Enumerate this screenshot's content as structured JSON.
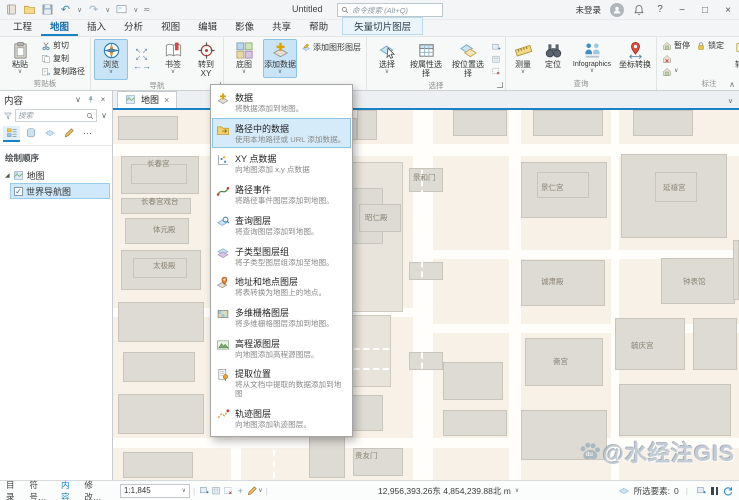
{
  "colors": {
    "accent": "#1a82c4",
    "tab_highlight": "#c9e4f6",
    "selection": "#cfe9fb",
    "map_bg": "#f8f1e8"
  },
  "titlebar": {
    "title": "Untitled",
    "search_placeholder": "命令搜索 (Alt+Q)",
    "signin": "未登录",
    "minimize": "−",
    "maximize": "□",
    "close": "×"
  },
  "ribbon_tabs": [
    {
      "label": "工程"
    },
    {
      "label": "地图",
      "active": true
    },
    {
      "label": "插入"
    },
    {
      "label": "分析"
    },
    {
      "label": "视图"
    },
    {
      "label": "编辑"
    },
    {
      "label": "影像"
    },
    {
      "label": "共享"
    },
    {
      "label": "帮助"
    }
  ],
  "contextual_tab": "矢量切片图层",
  "ribbon": {
    "paste": "粘贴",
    "cut": "剪切",
    "copy": "复制",
    "copy_path": "复制路径",
    "g_clipboard": "剪贴板",
    "explore": "浏览",
    "bookmarks": "书签",
    "goto_xy": "转到XY",
    "g_nav": "导航",
    "basemap": "底图",
    "add_data": "添加数据",
    "add_graphics": "添加图形图层",
    "select": "选择",
    "select_attr": "按属性选择",
    "select_loc": "按位置选择",
    "g_select": "选择",
    "measure": "测量",
    "locate": "定位",
    "infographics": "Infographics",
    "coord_conv": "坐标转换",
    "g_query": "查询",
    "pause": "暂停",
    "lock": "锁定",
    "convert": "转换",
    "g_label": "标注",
    "download": "下载地图",
    "g_offline": "离线"
  },
  "menu": {
    "items": [
      {
        "icon": "d_data",
        "label": "数据",
        "desc": "将数据添加到地图。"
      },
      {
        "icon": "d_path",
        "label": "路径中的数据",
        "desc": "使用本地路径或 URL 添加数据。",
        "selected": true
      },
      {
        "icon": "d_xy",
        "label": "XY 点数据",
        "desc": "向地图添加 x,y 点数据"
      },
      {
        "icon": "d_route",
        "label": "路径事件",
        "desc": "将路径事件图层添加到地图。"
      },
      {
        "icon": "d_query",
        "label": "查询图层",
        "desc": "将查询图层添加到地图。"
      },
      {
        "icon": "d_subtype",
        "label": "子类型图层组",
        "desc": "将子类型图层组添加至地图。"
      },
      {
        "icon": "d_address",
        "label": "地址和地点图层",
        "desc": "将表转换为地图上的地点。"
      },
      {
        "icon": "d_raster",
        "label": "多维栅格图层",
        "desc": "将多维栅格图层添加到地图。"
      },
      {
        "icon": "d_elev",
        "label": "高程源图层",
        "desc": "向地图添加高程源图层。"
      },
      {
        "icon": "d_extract",
        "label": "提取位置",
        "desc": "将从文档中提取的数据添加到地图"
      },
      {
        "icon": "d_track",
        "label": "轨迹图层",
        "desc": "向地图添加轨迹图层。"
      }
    ]
  },
  "contents": {
    "title": "内容",
    "search_placeholder": "搜索",
    "drawing_order": "绘制顺序",
    "map_node": "地图",
    "layer_name": "世界导航图",
    "layer_checked": "✓"
  },
  "map": {
    "tab": "地图",
    "close_glyph": "×",
    "watermark": "@水经注GIS",
    "labels": [
      {
        "t": "长春宫",
        "x": 34,
        "y": 48
      },
      {
        "t": "长春宫戏台",
        "x": 28,
        "y": 86
      },
      {
        "t": "体元殿",
        "x": 40,
        "y": 114
      },
      {
        "t": "太极殿",
        "x": 40,
        "y": 150
      },
      {
        "t": "交泰殿",
        "x": 200,
        "y": 16
      },
      {
        "t": "乾清宫",
        "x": 190,
        "y": 102
      },
      {
        "t": "昭仁殿",
        "x": 252,
        "y": 102
      },
      {
        "t": "景和门",
        "x": 300,
        "y": 62
      },
      {
        "t": "景仁宫",
        "x": 428,
        "y": 72
      },
      {
        "t": "延禧宫",
        "x": 550,
        "y": 72
      },
      {
        "t": "诚肃殿",
        "x": 428,
        "y": 166
      },
      {
        "t": "钟表馆",
        "x": 570,
        "y": 166
      },
      {
        "t": "斋宫",
        "x": 440,
        "y": 246
      },
      {
        "t": "毓庆宫",
        "x": 518,
        "y": 230
      },
      {
        "t": "贵友门",
        "x": 242,
        "y": 340
      }
    ]
  },
  "bottom": {
    "tabs": [
      {
        "label": "目录"
      },
      {
        "label": "符号…"
      },
      {
        "label": "内容",
        "active": true
      },
      {
        "label": "修改…"
      }
    ],
    "scale": "1:1,845",
    "coords": "12,956,393.26东 4,854,239.88北 m",
    "selected_label": "所选要素:",
    "selected_count": "0"
  }
}
